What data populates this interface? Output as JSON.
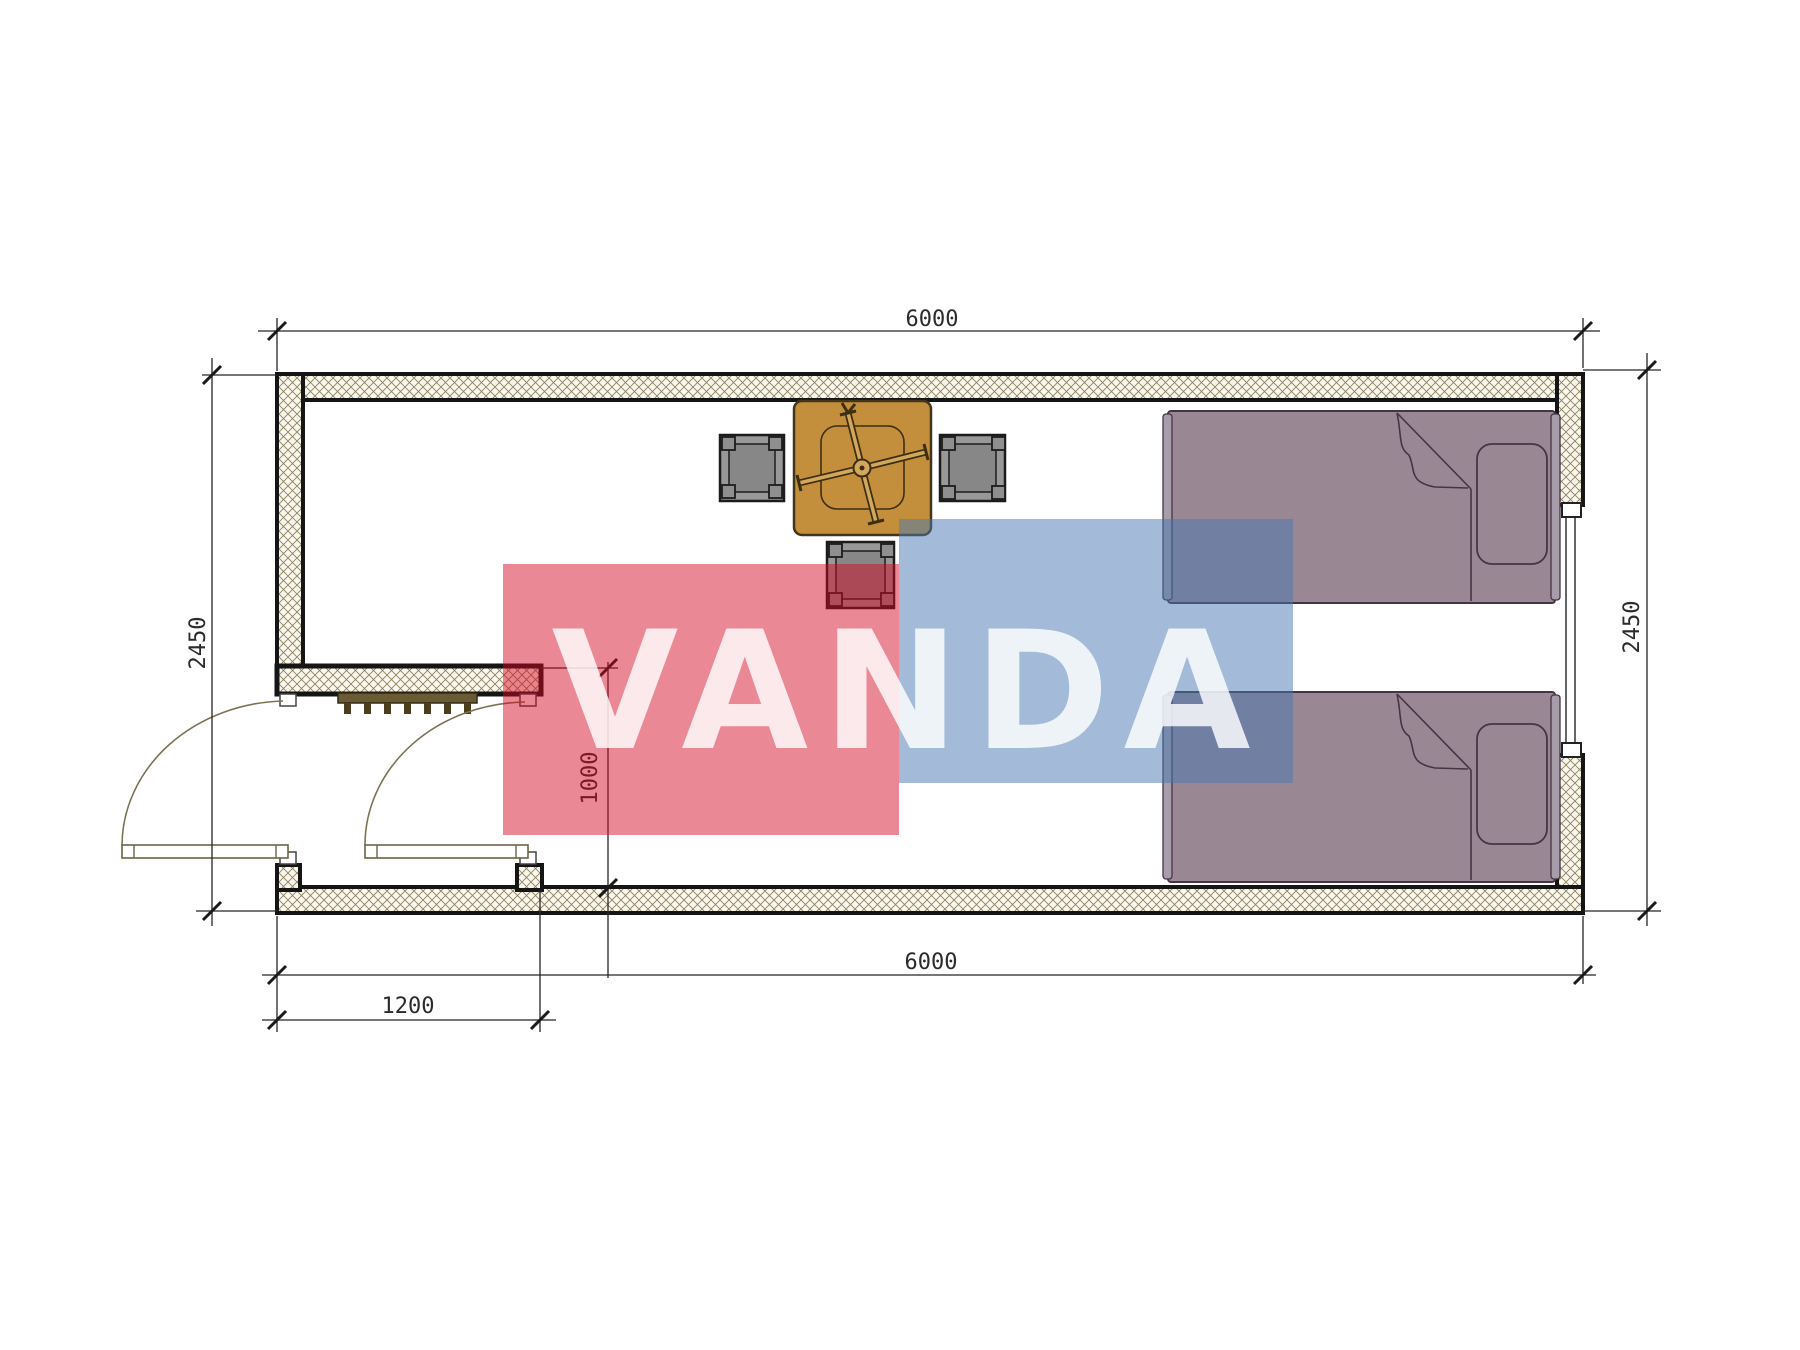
{
  "title": "container-cabin-floor-plan",
  "dimensions": {
    "top_width": "6000",
    "bottom_width": "6000",
    "left_height": "2450",
    "right_height": "2450",
    "porch_depth": "1000",
    "porch_door_width": "1200"
  },
  "watermark": {
    "text": "VANDA",
    "red_color": "#D50721",
    "blue_color": "#4777B1",
    "letter_color": "#ffffff"
  },
  "colors": {
    "wall_hatch_line": "#8d8263",
    "wall_hatch_bg": "#FAF7EC",
    "wall_outline": "#151515",
    "bed_fill": "#9a8794",
    "bed_outline": "#453544",
    "bed_rail_fill": "#a79daa",
    "table_fill": "#c48f3c",
    "table_detail": "#d3a85c",
    "stool_fill": "#989898",
    "stool_inner_fill": "#878787",
    "mat_fill": "#6a5b35"
  },
  "plan": {
    "rooms": [
      {
        "name": "main-room"
      },
      {
        "name": "entry-porch"
      }
    ],
    "furniture": [
      {
        "name": "dining-table"
      },
      {
        "name": "stool-left"
      },
      {
        "name": "stool-right"
      },
      {
        "name": "stool-bottom"
      },
      {
        "name": "bed-top"
      },
      {
        "name": "bed-bottom"
      },
      {
        "name": "doormat-grate"
      },
      {
        "name": "window-right-wall"
      },
      {
        "name": "exterior-door"
      },
      {
        "name": "interior-door"
      }
    ]
  }
}
